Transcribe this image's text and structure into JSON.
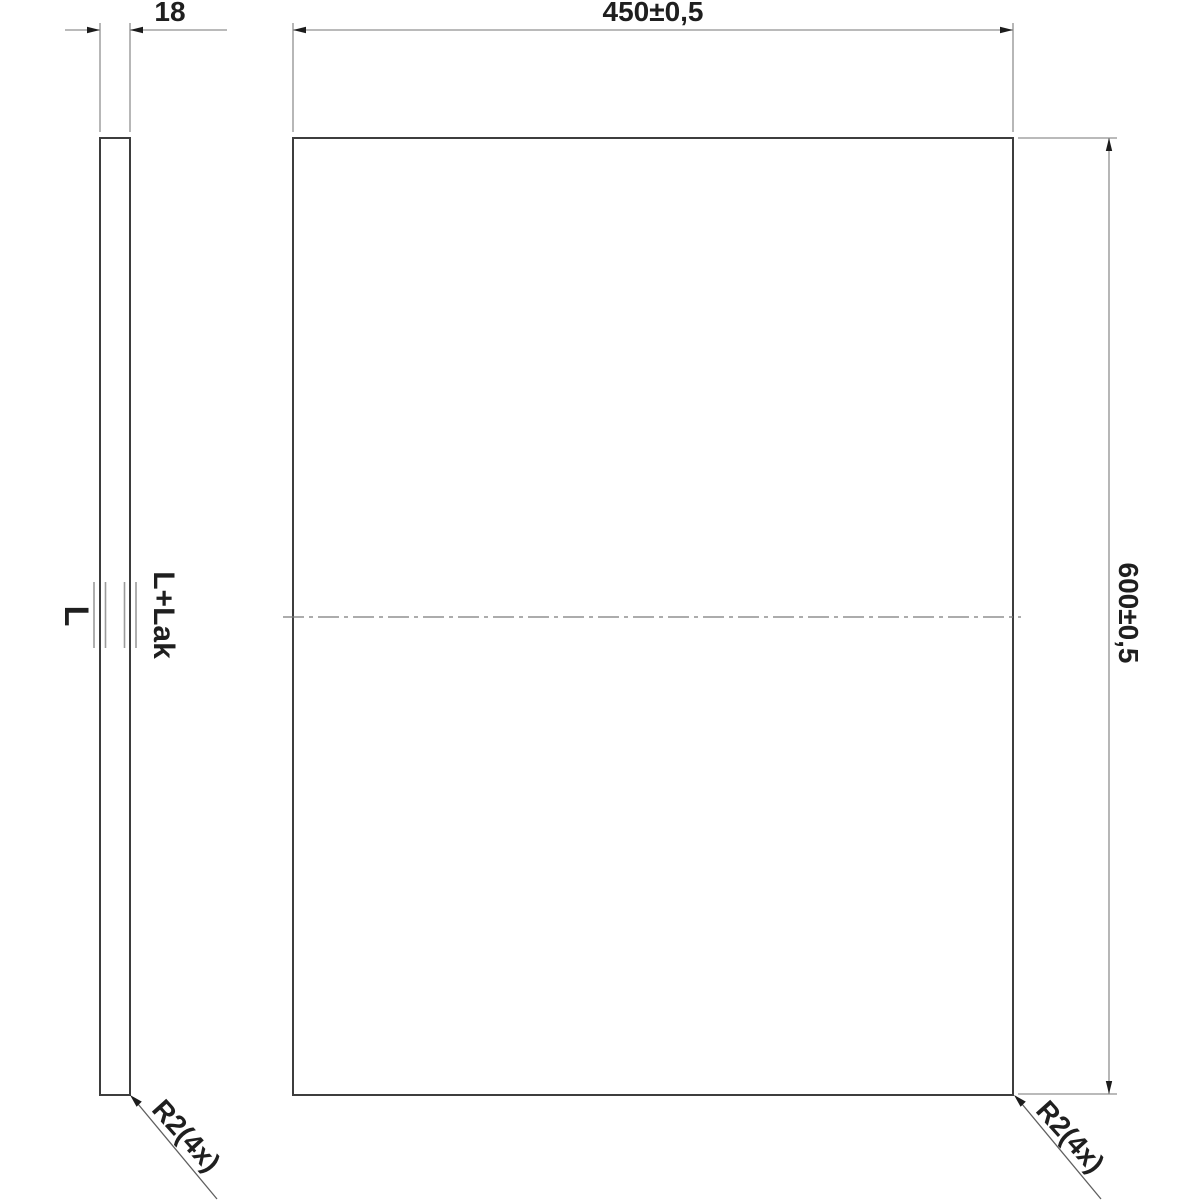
{
  "drawing": {
    "type": "technical-panel-drawing",
    "dims": {
      "thickness": "18",
      "width": "450±0,5",
      "height": "600±0,5"
    },
    "labels": {
      "surface_left": "L",
      "surface_right": "L+Lak",
      "radius_left": "R2(4x)",
      "radius_right": "R2(4x)"
    },
    "colors": {
      "background": "#ffffff",
      "outline": "#3d3d3d",
      "dimension_line": "#909090",
      "leader_line": "#5f5f5f",
      "arrowhead": "#1c1c1c",
      "centerline": "#7a7a7a",
      "surface_mark": "#9b9b9b",
      "text": "#1f1f1f"
    }
  }
}
